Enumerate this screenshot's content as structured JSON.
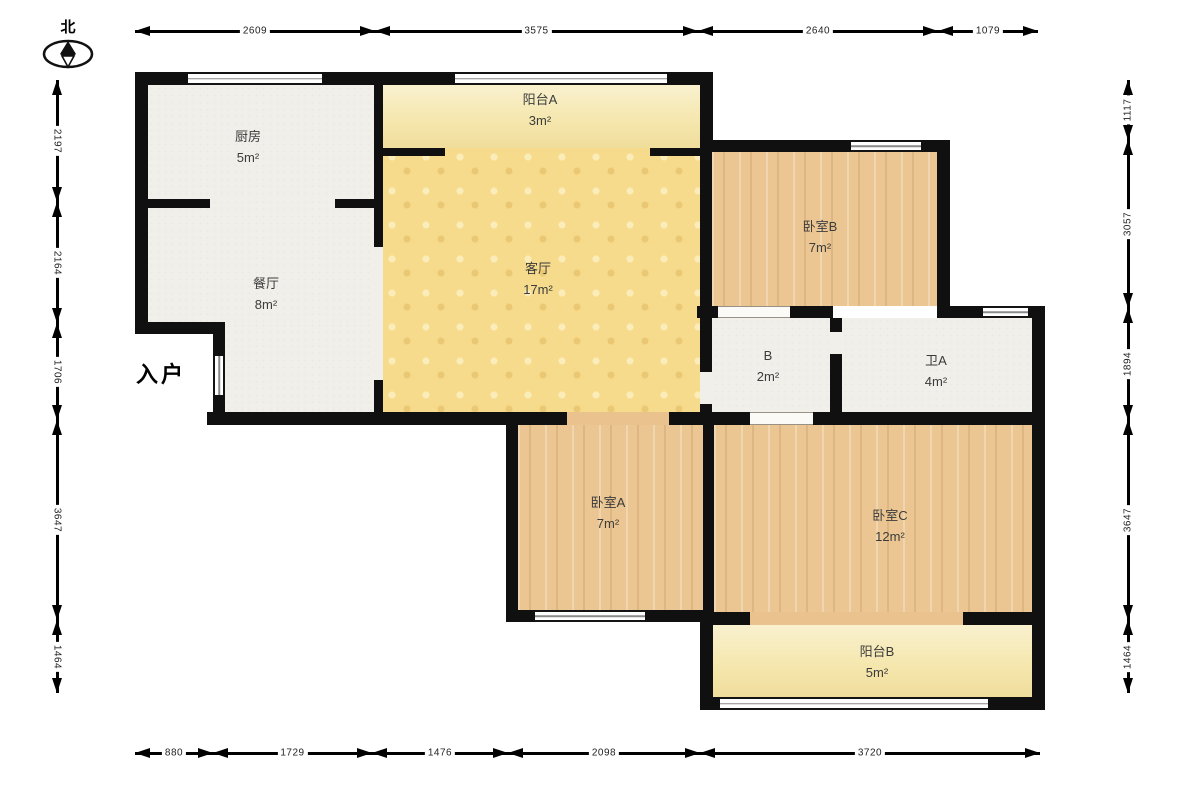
{
  "north_label": "北",
  "entrance_label": "入户",
  "rooms": [
    {
      "id": "kitchen",
      "name": "厨房",
      "area": "5m²"
    },
    {
      "id": "balcony-a",
      "name": "阳台A",
      "area": "3m²"
    },
    {
      "id": "living",
      "name": "客厅",
      "area": "17m²"
    },
    {
      "id": "bedroom-b",
      "name": "卧室B",
      "area": "7m²"
    },
    {
      "id": "dining",
      "name": "餐厅",
      "area": "8m²"
    },
    {
      "id": "hall-b",
      "name": "B",
      "area": "2m²"
    },
    {
      "id": "bath-a",
      "name": "卫A",
      "area": "4m²"
    },
    {
      "id": "bedroom-a",
      "name": "卧室A",
      "area": "7m²"
    },
    {
      "id": "bedroom-c",
      "name": "卧室C",
      "area": "12m²"
    },
    {
      "id": "balcony-b",
      "name": "阳台B",
      "area": "5m²"
    }
  ],
  "dimensions": {
    "top": [
      "2609",
      "3575",
      "2640",
      "1079"
    ],
    "bottom": [
      "880",
      "1729",
      "1476",
      "2098",
      "3720"
    ],
    "left": [
      "2197",
      "2164",
      "1706",
      "3647",
      "1464"
    ],
    "right": [
      "1117",
      "3057",
      "1894",
      "3647",
      "1464"
    ]
  },
  "colors": {
    "wall": "#101010",
    "floor_plain": "#f1efea",
    "floor_wood": "#ebc692",
    "floor_living": "#f6db8d",
    "floor_balcony": "#f5e7ae",
    "dimension_line": "#000000",
    "label_text": "#3b3b3b"
  }
}
